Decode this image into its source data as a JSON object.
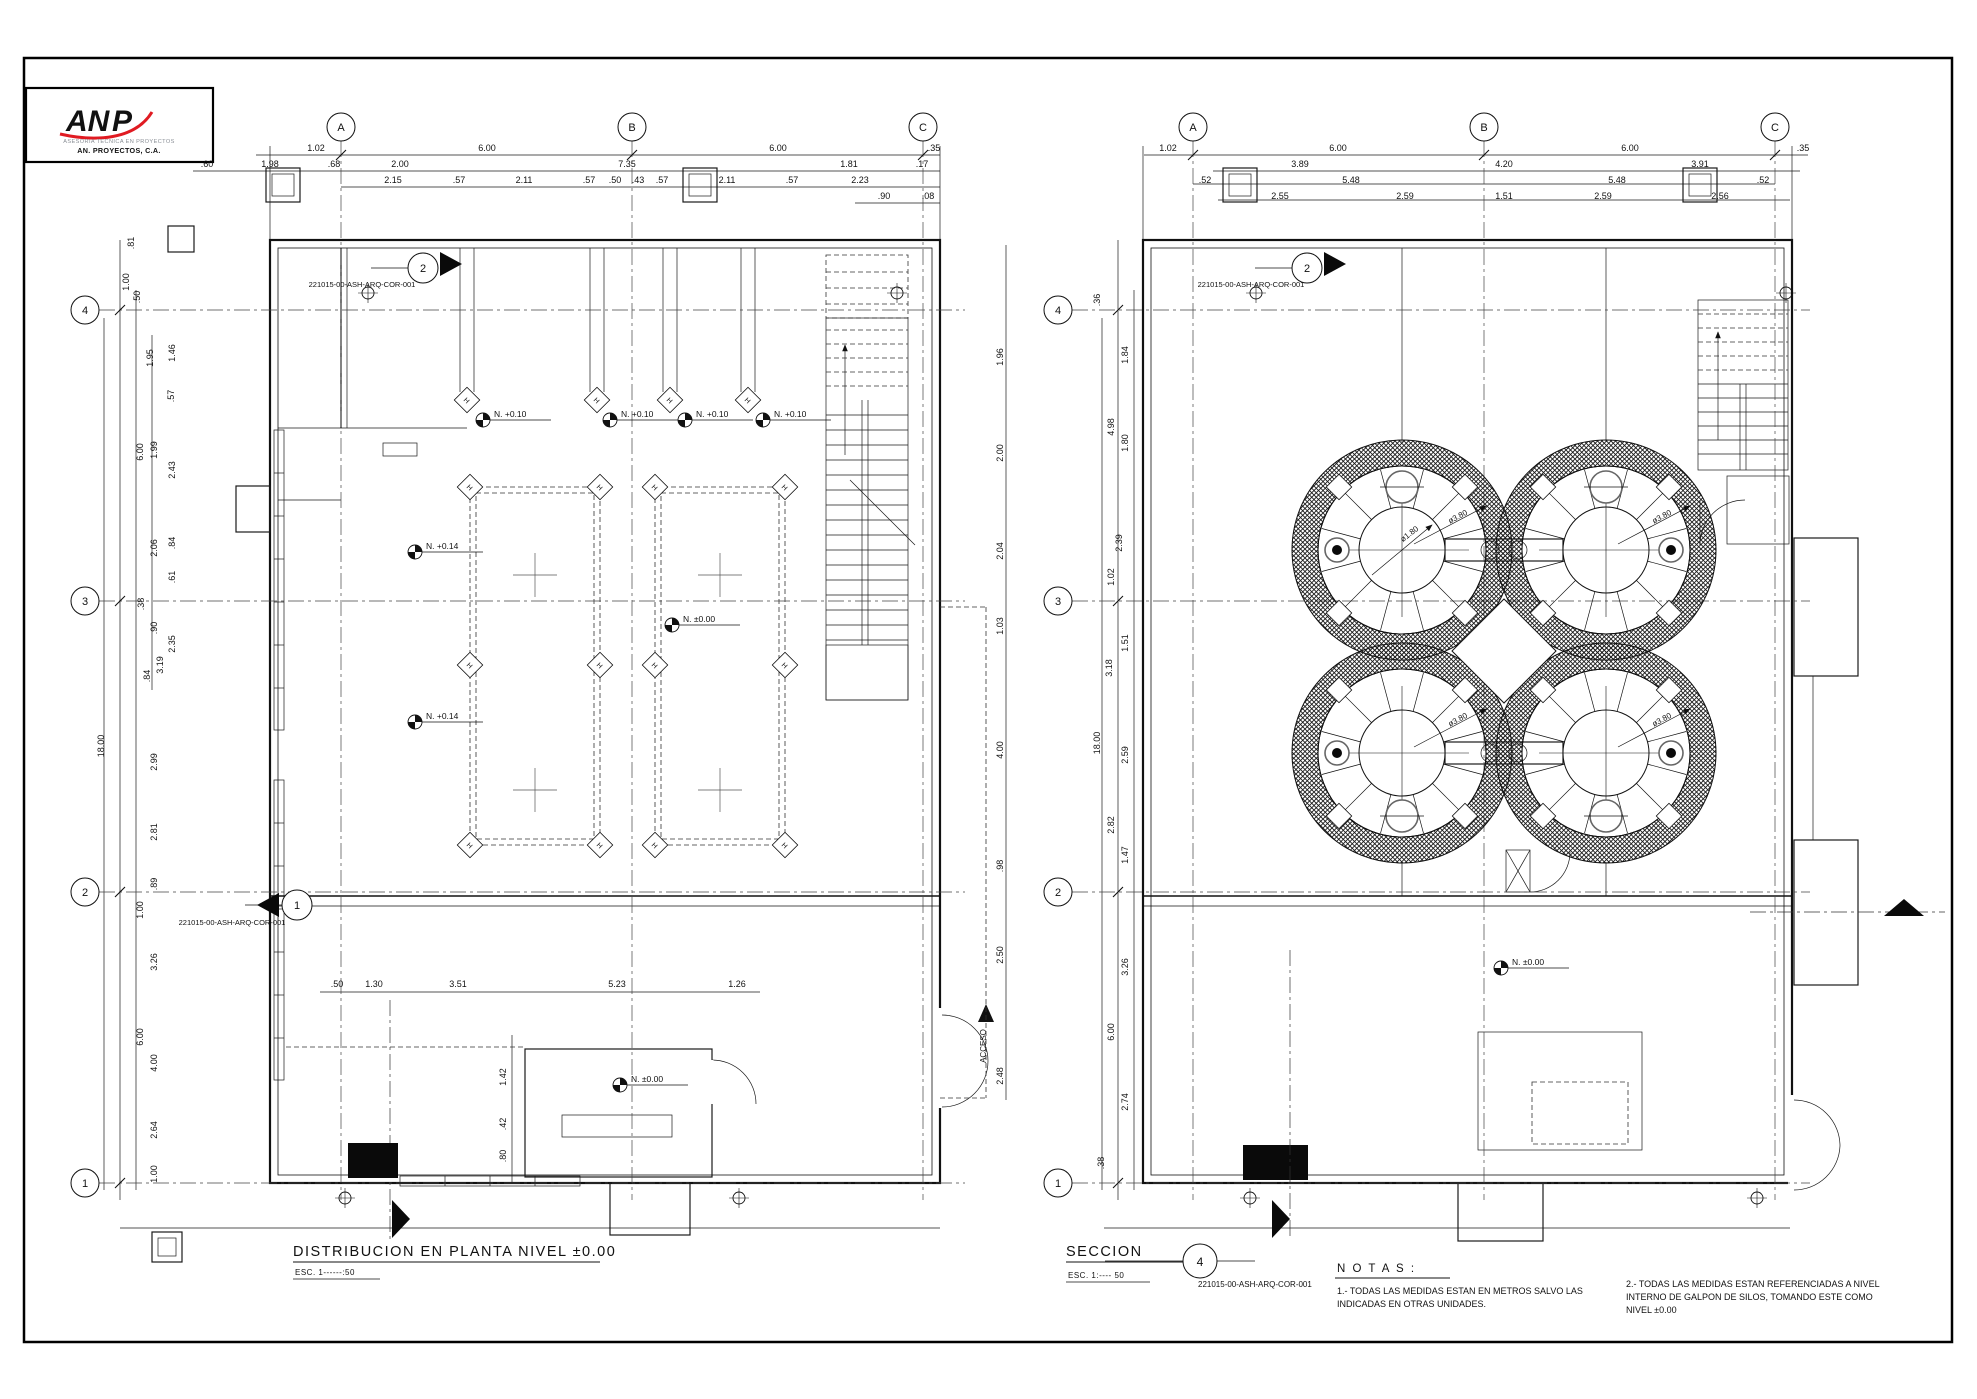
{
  "logo": {
    "brand_left": "AN",
    "brand_right": "P",
    "tagline": "ASESORIA TECNICA EN PROYECTOS",
    "company": "AN. PROYECTOS, C.A.",
    "blue": "#1535a8",
    "red": "#e01b22"
  },
  "left_title": {
    "title": "DISTRIBUCION EN PLANTA NIVEL ±0.00",
    "scale": "ESC. 1------:50"
  },
  "right_title": {
    "title": "SECCION",
    "scale": "ESC. 1:---- 50",
    "detail_number": "4",
    "ref": "221015-00-ASH-ARQ-COR-001"
  },
  "notes": {
    "heading": "N O T A S :",
    "n1a": "1.-  TODAS  LAS  MEDIDAS  ESTAN  EN  METROS  SALVO  LAS",
    "n1b": "INDICADAS  EN  OTRAS  UNIDADES.",
    "n2a": "2.-  TODAS  LAS  MEDIDAS  ESTAN  REFERENCIADAS  A  NIVEL",
    "n2b": "INTERNO  DE  GALPON  DE  SILOS,  TOMANDO  ESTE  COMO",
    "n2c": "NIVEL  ±0.00"
  },
  "left_plan": {
    "grid": {
      "bubble_r": 14,
      "col_bubble_y": 127,
      "col_line_y1": 141,
      "col_line_y2": 1200,
      "cols": [
        {
          "label": "A",
          "x": 341
        },
        {
          "label": "B",
          "x": 632
        },
        {
          "label": "C",
          "x": 923
        }
      ],
      "row_bubble_x": 85,
      "row_line_x1": 99,
      "row_line_x2": 965,
      "rows": [
        {
          "label": "4",
          "y": 310
        },
        {
          "label": "3",
          "y": 601
        },
        {
          "label": "2",
          "y": 892
        },
        {
          "label": "1",
          "y": 1183
        }
      ],
      "tick_x": 120,
      "tick_y": 155
    },
    "diamonds": [
      [
        467,
        400
      ],
      [
        597,
        400
      ],
      [
        670,
        400
      ],
      [
        748,
        400
      ],
      [
        470,
        487
      ],
      [
        600,
        487
      ],
      [
        655,
        487
      ],
      [
        785,
        487
      ],
      [
        470,
        665
      ],
      [
        600,
        665
      ],
      [
        655,
        665
      ],
      [
        785,
        665
      ],
      [
        470,
        845
      ],
      [
        600,
        845
      ],
      [
        655,
        845
      ],
      [
        785,
        845
      ]
    ],
    "diamond_glyph": "H",
    "plus_marks": [
      [
        535,
        575
      ],
      [
        720,
        575
      ],
      [
        535,
        790
      ],
      [
        720,
        790
      ]
    ]
  },
  "right_plan": {
    "grid": {
      "bubble_r": 14,
      "col_bubble_y": 127,
      "col_line_y1": 141,
      "col_line_y2": 1200,
      "cols": [
        {
          "label": "A",
          "x": 1193
        },
        {
          "label": "B",
          "x": 1484
        },
        {
          "label": "C",
          "x": 1775
        }
      ],
      "row_bubble_x": 1058,
      "row_line_x1": 1072,
      "row_line_x2": 1810,
      "rows": [
        {
          "label": "4",
          "y": 310
        },
        {
          "label": "3",
          "y": 601
        },
        {
          "label": "2",
          "y": 892
        },
        {
          "label": "1",
          "y": 1183
        }
      ],
      "tick_x": 1118,
      "tick_y": 155
    },
    "silos": {
      "r_out": 110,
      "r_in": 84,
      "r_hub": 43,
      "dia_label": "ø3.80",
      "hub_label": "ø1.80",
      "centers": [
        {
          "cx": 1402,
          "cy": 550,
          "dot": "l",
          "man": "t",
          "hub_arrow": true
        },
        {
          "cx": 1606,
          "cy": 550,
          "dot": "r",
          "man": "t"
        },
        {
          "cx": 1402,
          "cy": 753,
          "dot": "l",
          "man": "b"
        },
        {
          "cx": 1606,
          "cy": 753,
          "dot": "r",
          "man": "b"
        }
      ]
    }
  },
  "level_markers": [
    {
      "x": 483,
      "y": 420,
      "t": "N. +0.10"
    },
    {
      "x": 610,
      "y": 420,
      "t": "N. +0.10"
    },
    {
      "x": 685,
      "y": 420,
      "t": "N. +0.10"
    },
    {
      "x": 763,
      "y": 420,
      "t": "N. +0.10"
    },
    {
      "x": 415,
      "y": 552,
      "t": "N. +0.14"
    },
    {
      "x": 415,
      "y": 722,
      "t": "N. +0.14"
    },
    {
      "x": 672,
      "y": 625,
      "t": "N. ±0.00"
    },
    {
      "x": 620,
      "y": 1085,
      "t": "N. ±0.00"
    },
    {
      "x": 1473,
      "y": 655,
      "t": "N. +15.98"
    },
    {
      "x": 1501,
      "y": 968,
      "t": "N. ±0.00"
    }
  ],
  "section_markers": [
    {
      "x": 423,
      "y": 268,
      "label": "2",
      "dir": "r"
    },
    {
      "x": 1307,
      "y": 268,
      "label": "2",
      "dir": "r"
    },
    {
      "x": 297,
      "y": 905,
      "label": "1",
      "dir": "l"
    }
  ],
  "target_marks": [
    [
      368,
      293
    ],
    [
      897,
      293
    ],
    [
      1256,
      293
    ],
    [
      1786,
      293
    ],
    [
      345,
      1198
    ],
    [
      739,
      1198
    ],
    [
      1250,
      1198
    ],
    [
      1757,
      1198
    ]
  ],
  "annotations": [
    [
      316,
      151,
      "1.02"
    ],
    [
      487,
      151,
      "6.00"
    ],
    [
      778,
      151,
      "6.00"
    ],
    [
      934,
      151,
      ".35"
    ],
    [
      207,
      167,
      ".60"
    ],
    [
      270,
      167,
      "1.98"
    ],
    [
      334,
      167,
      ".68"
    ],
    [
      400,
      167,
      "2.00"
    ],
    [
      627,
      167,
      "7.35"
    ],
    [
      849,
      167,
      "1.81"
    ],
    [
      922,
      167,
      ".17"
    ],
    [
      393,
      183,
      "2.15"
    ],
    [
      459,
      183,
      ".57"
    ],
    [
      524,
      183,
      "2.11"
    ],
    [
      589,
      183,
      ".57"
    ],
    [
      615,
      183,
      ".50"
    ],
    [
      638,
      183,
      ".43"
    ],
    [
      662,
      183,
      ".57"
    ],
    [
      727,
      183,
      "2.11"
    ],
    [
      792,
      183,
      ".57"
    ],
    [
      860,
      183,
      "2.23"
    ],
    [
      884,
      199,
      ".90"
    ],
    [
      928,
      199,
      ".08"
    ],
    [
      134,
      243,
      ".81",
      -90
    ],
    [
      129,
      282,
      "1.00",
      -90
    ],
    [
      140,
      297,
      ".50",
      -90
    ],
    [
      153,
      358,
      "1.95",
      -90
    ],
    [
      175,
      353,
      "1.46",
      -90
    ],
    [
      174,
      396,
      ".57",
      -90
    ],
    [
      143,
      452,
      "6.00",
      -90
    ],
    [
      157,
      450,
      "1.99",
      -90
    ],
    [
      175,
      470,
      "2.43",
      -90
    ],
    [
      157,
      548,
      "2.06",
      -90
    ],
    [
      175,
      543,
      ".84",
      -90
    ],
    [
      175,
      577,
      ".61",
      -90
    ],
    [
      144,
      604,
      ".38",
      -90
    ],
    [
      157,
      628,
      ".90",
      -90
    ],
    [
      175,
      644,
      "2.35",
      -90
    ],
    [
      163,
      665,
      "3.19",
      -90
    ],
    [
      150,
      676,
      ".84",
      -90
    ],
    [
      157,
      762,
      "2.99",
      -90
    ],
    [
      157,
      832,
      "2.81",
      -90
    ],
    [
      157,
      884,
      ".89",
      -90
    ],
    [
      143,
      910,
      "1.00",
      -90
    ],
    [
      157,
      962,
      "3.26",
      -90
    ],
    [
      104,
      746,
      "18.00",
      -90
    ],
    [
      143,
      1037,
      "6.00",
      -90
    ],
    [
      157,
      1063,
      "4.00",
      -90
    ],
    [
      157,
      1130,
      "2.64",
      -90
    ],
    [
      157,
      1174,
      "1.00",
      -90
    ],
    [
      1003,
      357,
      "1.96",
      -90
    ],
    [
      1003,
      453,
      "2.00",
      -90
    ],
    [
      1003,
      551,
      "2.04",
      -90
    ],
    [
      1003,
      626,
      "1.03",
      -90
    ],
    [
      1003,
      750,
      "4.00",
      -90
    ],
    [
      1003,
      866,
      ".98",
      -90
    ],
    [
      1003,
      955,
      "2.50",
      -90
    ],
    [
      1003,
      1076,
      "2.48",
      -90
    ],
    [
      986,
      1046,
      "ACCESO",
      -90,
      8
    ],
    [
      337,
      987,
      ".50"
    ],
    [
      374,
      987,
      "1.30"
    ],
    [
      458,
      987,
      "3.51"
    ],
    [
      617,
      987,
      "5.23"
    ],
    [
      737,
      987,
      "1.26"
    ],
    [
      506,
      1077,
      "1.42",
      -90
    ],
    [
      506,
      1124,
      ".42",
      -90
    ],
    [
      506,
      1156,
      ".80",
      -90
    ],
    [
      362,
      287,
      "221015-00-ASH-ARQ-COR-001",
      0,
      7.5
    ],
    [
      1251,
      287,
      "221015-00-ASH-ARQ-COR-001",
      0,
      7.5
    ],
    [
      232,
      925,
      "221015-00-ASH-ARQ-COR-001",
      0,
      7.5
    ],
    [
      1168,
      151,
      "1.02"
    ],
    [
      1338,
      151,
      "6.00"
    ],
    [
      1630,
      151,
      "6.00"
    ],
    [
      1803,
      151,
      ".35"
    ],
    [
      1300,
      167,
      "3.89"
    ],
    [
      1504,
      167,
      "4.20"
    ],
    [
      1700,
      167,
      "3.91"
    ],
    [
      1205,
      183,
      ".52"
    ],
    [
      1351,
      183,
      "5.48"
    ],
    [
      1617,
      183,
      "5.48"
    ],
    [
      1763,
      183,
      ".52"
    ],
    [
      1280,
      199,
      "2.55"
    ],
    [
      1405,
      199,
      "2.59"
    ],
    [
      1504,
      199,
      "1.51"
    ],
    [
      1603,
      199,
      "2.59"
    ],
    [
      1720,
      199,
      "2.56"
    ],
    [
      1100,
      300,
      ".36",
      -90
    ],
    [
      1128,
      355,
      "1.84",
      -90
    ],
    [
      1114,
      427,
      "4.98",
      -90
    ],
    [
      1128,
      443,
      "1.80",
      -90
    ],
    [
      1122,
      543,
      "2.39",
      -90
    ],
    [
      1114,
      577,
      "1.02",
      -90
    ],
    [
      1128,
      643,
      "1.51",
      -90
    ],
    [
      1112,
      668,
      "3.18",
      -90
    ],
    [
      1100,
      743,
      "18.00",
      -90
    ],
    [
      1128,
      755,
      "2.59",
      -90
    ],
    [
      1114,
      825,
      "2.82",
      -90
    ],
    [
      1128,
      855,
      "1.47",
      -90
    ],
    [
      1128,
      967,
      "3.26",
      -90
    ],
    [
      1114,
      1032,
      "6.00",
      -90
    ],
    [
      1128,
      1102,
      "2.74",
      -90
    ],
    [
      1104,
      1163,
      ".38",
      -90
    ]
  ]
}
